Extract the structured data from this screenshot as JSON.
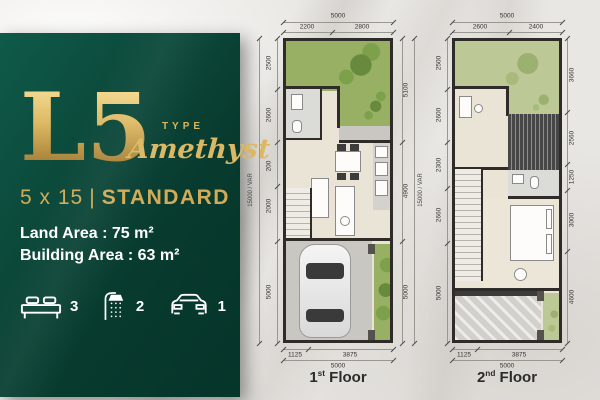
{
  "panel": {
    "type_code": "L5",
    "type_label": "TYPE",
    "type_name": "Amethyst",
    "size": "5 x 15",
    "divider": "|",
    "grade": "STANDARD",
    "land_area": "Land Area : 75 m²",
    "building_area": "Building Area : 63 m²",
    "features": [
      {
        "icon": "bed-icon",
        "count": "3"
      },
      {
        "icon": "shower-icon",
        "count": "2"
      },
      {
        "icon": "car-icon",
        "count": "1"
      }
    ],
    "colors": {
      "panel_green": "#0b4739",
      "gold": "#d3ab57",
      "text_white": "#ffffff"
    }
  },
  "floor1": {
    "label_num": "1",
    "label_sup": "st",
    "label_word": "Floor",
    "dims": {
      "top_overall": "5000",
      "top_segments": [
        "2200",
        "2800"
      ],
      "left_outer": "15000 / VAR",
      "left_segments": [
        "2500",
        "2600",
        "200",
        "2000",
        "5000"
      ],
      "right_segments": [
        "5100",
        "4900",
        "5000"
      ],
      "right_outer": "15000 / VAR",
      "bottom_segments": [
        "1125",
        "3875"
      ],
      "bottom_overall": "5000"
    }
  },
  "floor2": {
    "label_num": "2",
    "label_sup": "nd",
    "label_word": "Floor",
    "dims": {
      "top_overall": "5000",
      "top_segments": [
        "2600",
        "2400"
      ],
      "left_segments": [
        "2500",
        "2600",
        "2300",
        "2660",
        "5000"
      ],
      "right_segments": [
        "3660",
        "2560",
        "1250",
        "3000",
        "4600"
      ],
      "bottom_segments": [
        "1125",
        "3875"
      ],
      "bottom_overall": "5000"
    }
  }
}
